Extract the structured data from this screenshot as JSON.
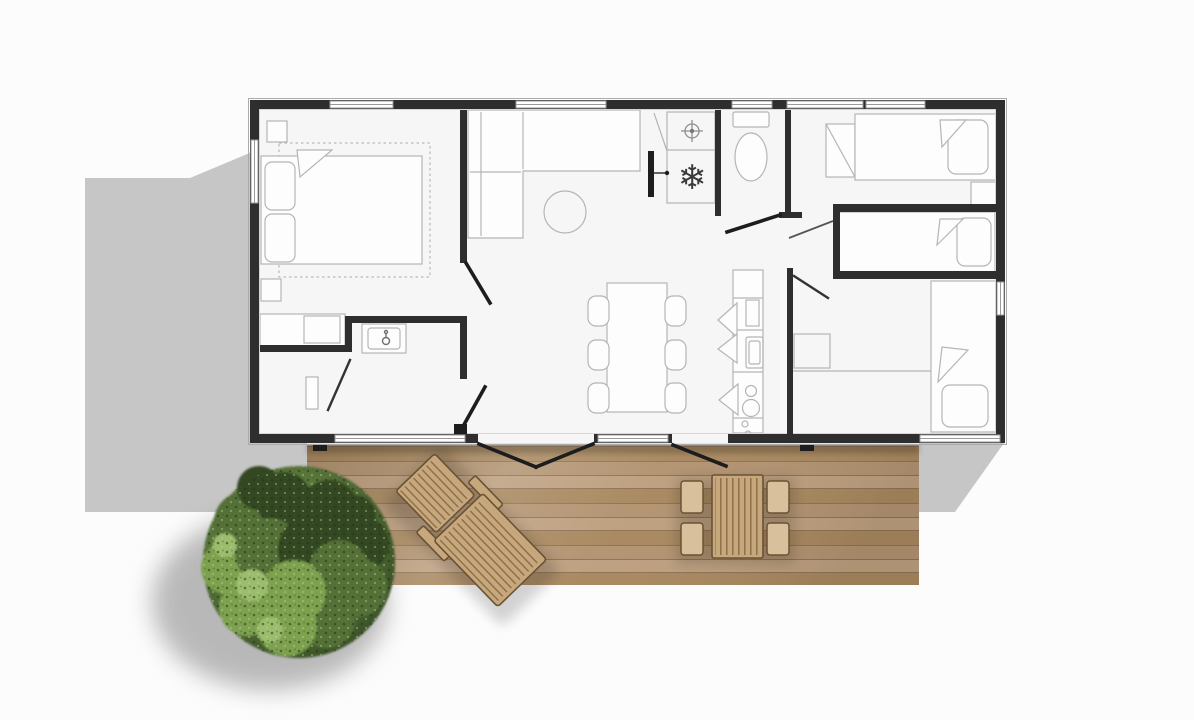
{
  "meta": {
    "type": "floor-plan",
    "view": "top-down",
    "description": "Mobile home floor plan seen from above with wooden deck, lounge chair, outdoor dining set and a round tree"
  },
  "palette": {
    "page": "#fcfcfc",
    "shadow": "#c6c6c6",
    "floor": "#f6f6f6",
    "wall": "#2e2e2e",
    "line": "#b5b5b5",
    "black": "#1d1d1d",
    "deck_base": "#b29371",
    "deck_stripe": "#bd9f7e",
    "deck_gap": "#8f7252",
    "deck_light": "#a8885f",
    "wood_edge": "#6a5233",
    "wood_fill": "#c7a87d",
    "wood_fill_light": "#d9c09c",
    "wood_slat": "#8a6c48",
    "tree_dark": "#324722",
    "tree_mid": "#557138",
    "tree_light": "#7da150",
    "tree_pale": "#9cbd6d"
  },
  "glyphs": {
    "snowflake": "❄"
  },
  "rooms": [
    {
      "name": "master-bedroom"
    },
    {
      "name": "shower-room"
    },
    {
      "name": "entry-hall"
    },
    {
      "name": "living-room"
    },
    {
      "name": "kitchen"
    },
    {
      "name": "bathroom"
    },
    {
      "name": "wc"
    },
    {
      "name": "hallway"
    },
    {
      "name": "bedroom-2"
    },
    {
      "name": "bed-nook"
    },
    {
      "name": "bedroom-3"
    }
  ],
  "furniture": [
    {
      "name": "double-bed"
    },
    {
      "name": "single-bed-1"
    },
    {
      "name": "single-bed-2"
    },
    {
      "name": "single-bed-3"
    },
    {
      "name": "corner-sofa"
    },
    {
      "name": "coffee-table"
    },
    {
      "name": "dining-table"
    },
    {
      "name": "dining-chairs"
    },
    {
      "name": "kitchen-counter"
    },
    {
      "name": "vanity-sink"
    },
    {
      "name": "toilet"
    },
    {
      "name": "shower"
    },
    {
      "name": "wardrobe"
    },
    {
      "name": "shelf-rack"
    },
    {
      "name": "lounge-chair"
    },
    {
      "name": "outdoor-dining-set"
    },
    {
      "name": "tree"
    }
  ]
}
